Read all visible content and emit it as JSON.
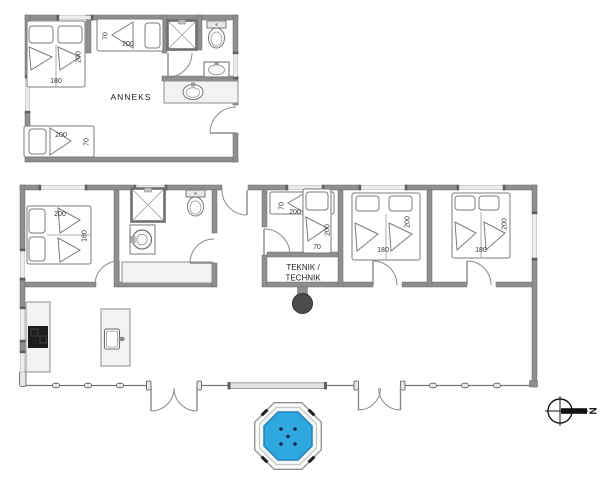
{
  "plan": {
    "anneks": {
      "label": "ANNEKS",
      "beds": {
        "double": {
          "width": "180",
          "length": "200"
        },
        "single_top": {
          "width": "70",
          "length": "200"
        },
        "single_bottom": {
          "width": "70",
          "length": "200"
        }
      }
    },
    "main": {
      "technical_room": {
        "line1": "TEKNIK /",
        "line2": "TECHNIK"
      },
      "beds": {
        "left": {
          "width": "180",
          "length": "200"
        },
        "bunk_upper": {
          "width": "70",
          "length": "200"
        },
        "bunk_lower": {
          "width": "70",
          "length": "200"
        },
        "middle": {
          "width": "180",
          "length": "200"
        },
        "right": {
          "width": "180",
          "length": "200"
        }
      }
    },
    "compass": {
      "north": "N"
    },
    "colors": {
      "wall": "#8f8f8f",
      "window": "#ececec",
      "water": "#2fa7e0",
      "water_edge": "#1f83b5",
      "cooktop": "#1c1c1c",
      "stove_unit": "#4c4c4c"
    }
  }
}
